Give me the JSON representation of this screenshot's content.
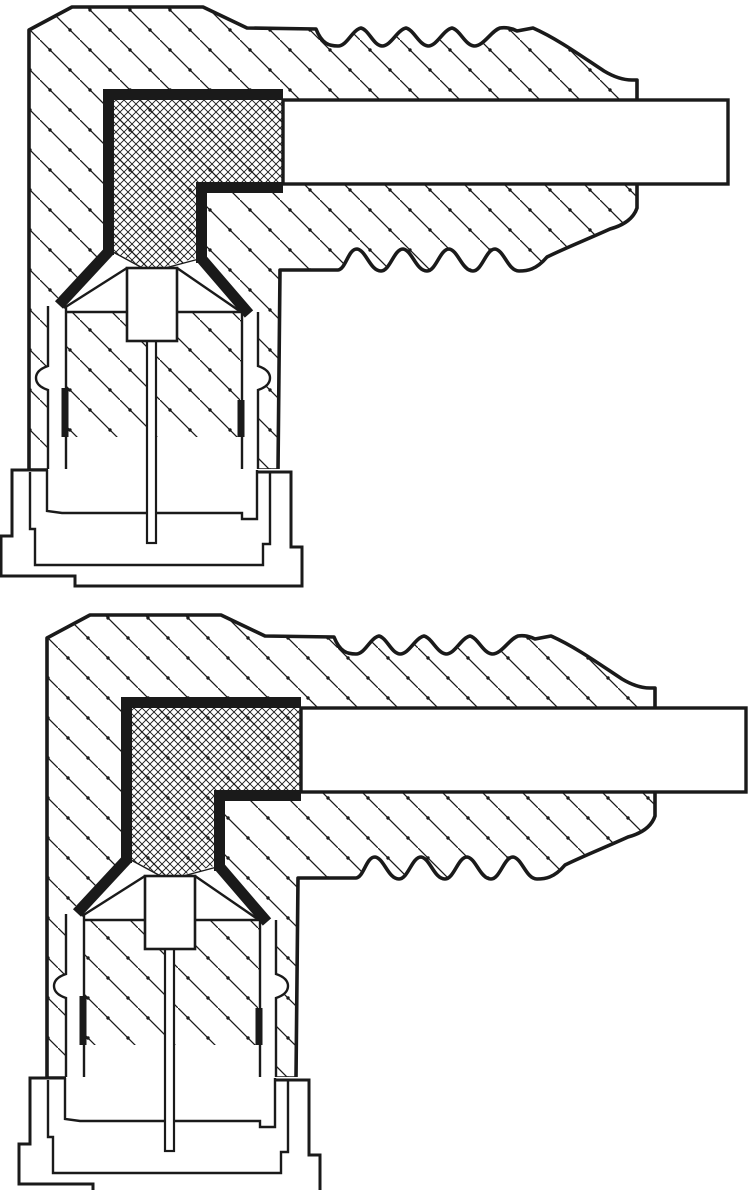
{
  "meta": {
    "title": "Spark plug connector cross-sections",
    "description": "Two black-and-white technical sectional drawings of right-angle spark plug connectors, stacked vertically",
    "text_content": "none — drawing contains no visible text, labels or dimensions"
  },
  "colors": {
    "ink": "#1a1a1a",
    "paper": "#ffffff"
  },
  "figures": [
    {
      "id": "upper",
      "label": "upper connector cross-section",
      "transform": "translate(0,0)",
      "parts": [
        "hatched-boot-body",
        "ribbed-strain-relief",
        "cable-channel",
        "metal-contact-shield",
        "cross-hatched-insert",
        "socket-cavity",
        "terminal-nut",
        "center-electrode-pin",
        "stepped-plug-base"
      ]
    },
    {
      "id": "lower",
      "label": "lower connector cross-section",
      "transform": "translate(18,608)",
      "parts": [
        "hatched-boot-body",
        "ribbed-strain-relief",
        "cable-channel",
        "metal-contact-shield",
        "cross-hatched-insert",
        "socket-cavity",
        "terminal-nut",
        "center-electrode-pin",
        "stepped-plug-base"
      ]
    }
  ]
}
